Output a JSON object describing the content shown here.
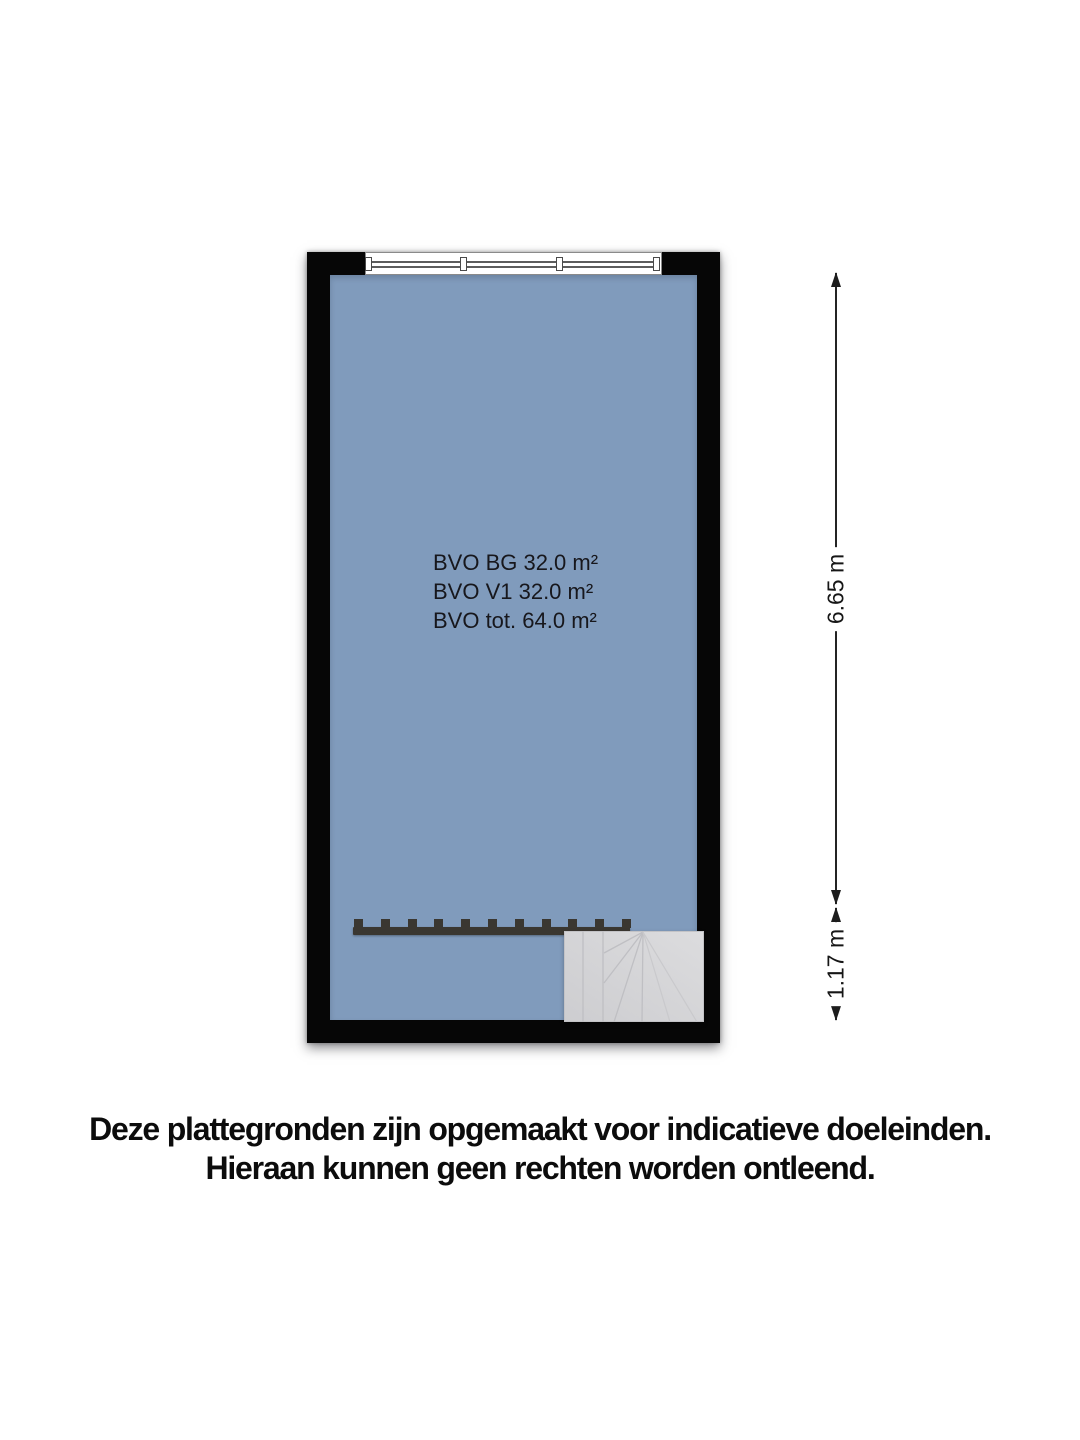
{
  "floorplan": {
    "colors": {
      "room_fill": "#809BBC",
      "wall": "#060606",
      "stair_fill": "#D3D3D5",
      "stair_line": "#BFBFC3",
      "railing": "#3A3731",
      "dimension": "#1D1D1D"
    },
    "labels": [
      "BVO BG 32.0 m²",
      "BVO V1 32.0 m²",
      "BVO tot. 64.0 m²"
    ],
    "window": {
      "panes": 3
    },
    "railing": {
      "post_count": 11
    }
  },
  "dimensions": [
    {
      "label": "6.65 m"
    },
    {
      "label": "1.17 m"
    }
  ],
  "disclaimer": {
    "line1": "Deze plattegronden zijn opgemaakt voor indicatieve doeleinden.",
    "line2": "Hieraan kunnen geen rechten worden ontleend."
  }
}
